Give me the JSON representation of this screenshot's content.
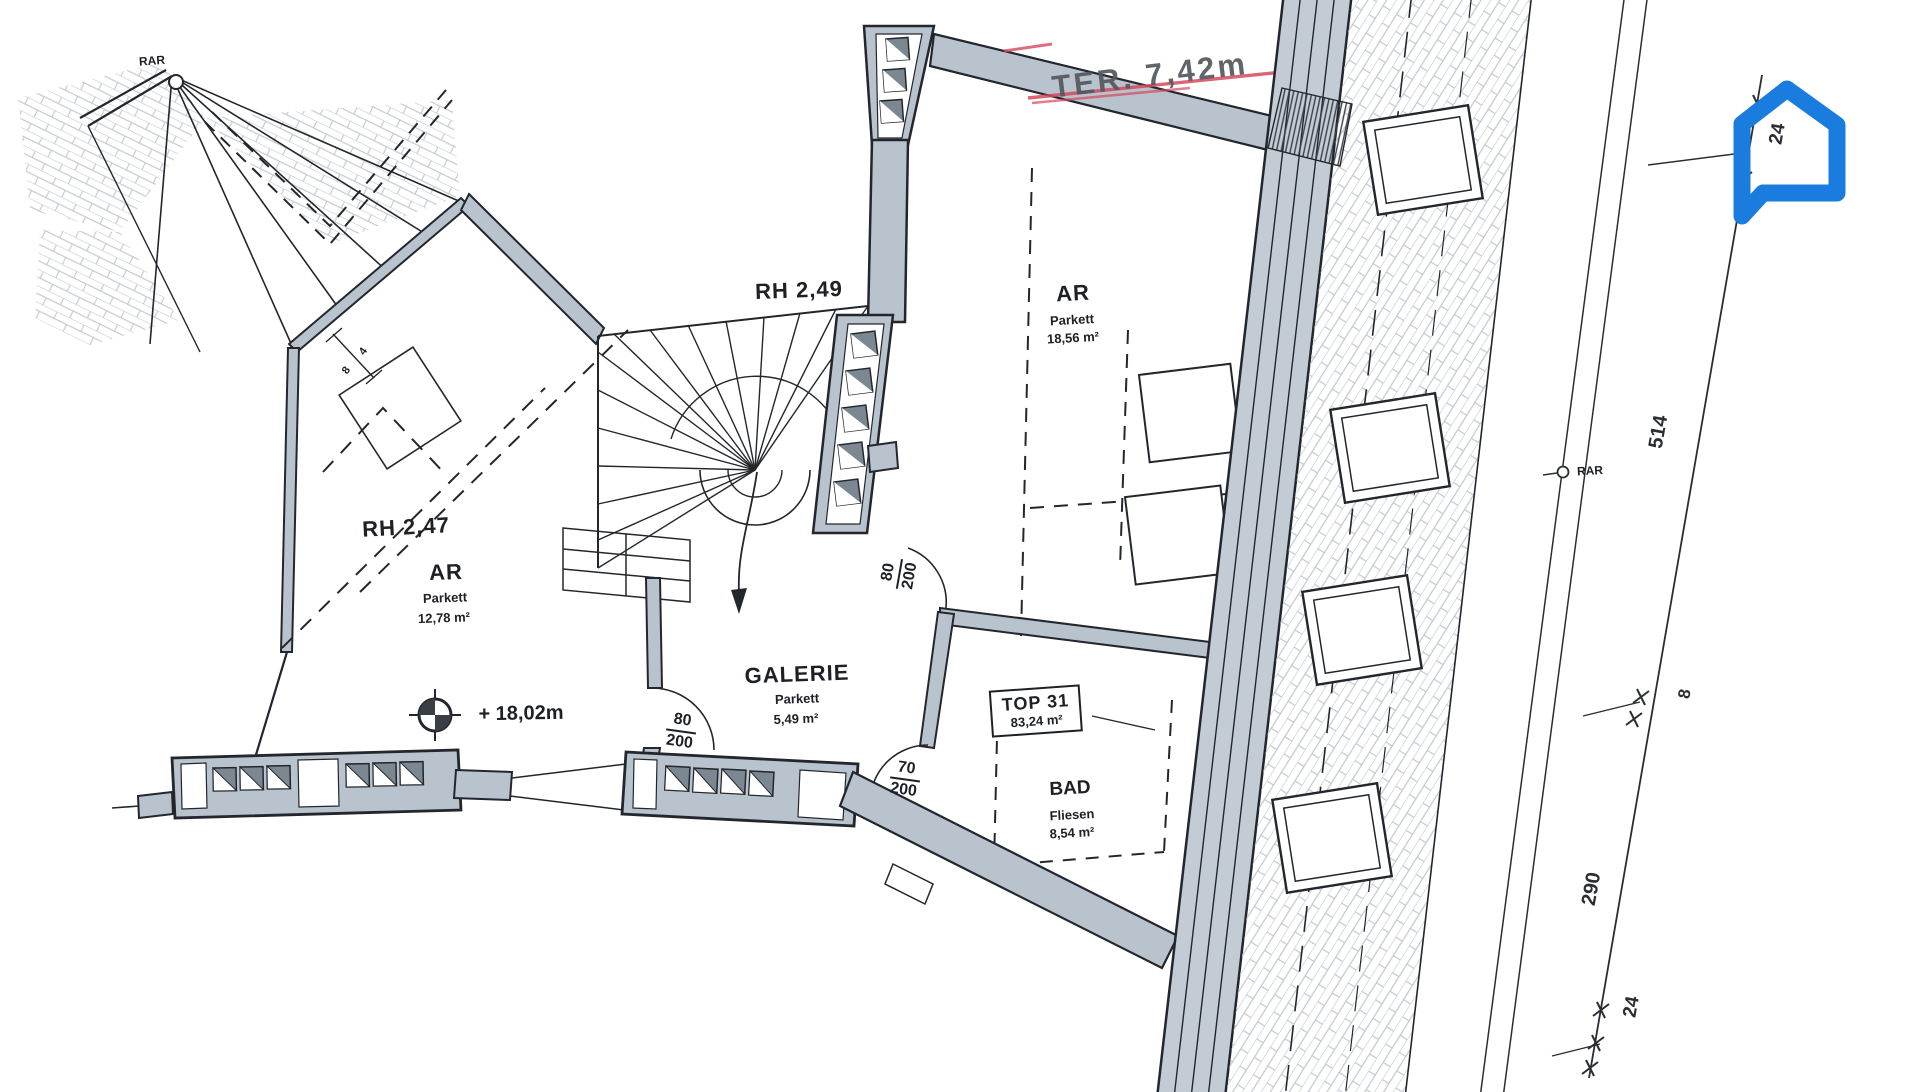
{
  "document": {
    "type": "floor-plan-scan"
  },
  "labels": {
    "rar_left": "RAR",
    "rar_right": "RAR",
    "rh_left": "RH 2,47",
    "rh_right": "RH 2,49",
    "ter": "TER. 7,42m",
    "level": "+ 18,02m"
  },
  "rooms": [
    {
      "name": "AR",
      "floor": "Parkett",
      "area": "12,78 m²"
    },
    {
      "name": "AR",
      "floor": "Parkett",
      "area": "18,56 m²"
    },
    {
      "name": "GALERIE",
      "floor": "Parkett",
      "area": "5,49 m²"
    },
    {
      "name": "BAD",
      "floor": "Fliesen",
      "area": "8,54 m²"
    }
  ],
  "unit": {
    "label": "TOP 31",
    "area": "83,24 m²"
  },
  "doors": [
    {
      "width": "80",
      "height": "200"
    },
    {
      "width": "80",
      "height": "200"
    },
    {
      "width": "70",
      "height": "200"
    }
  ],
  "dims": {
    "top": "24",
    "main": "514",
    "small": "8",
    "lower": "290",
    "bottom": "24",
    "wall_a": "4",
    "wall_b": "8"
  },
  "colors": {
    "wall": "#b9c3cd",
    "line": "#23272d",
    "pane": "#7b8791",
    "red": "#d5495e",
    "logo_blue": "#1b7ce0"
  }
}
